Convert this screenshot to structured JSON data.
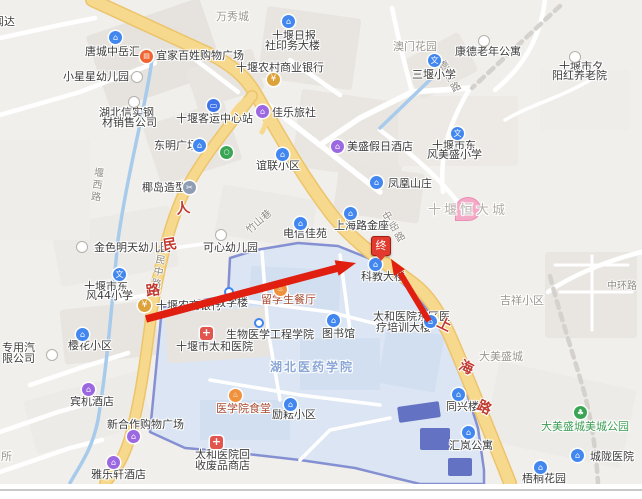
{
  "route": {
    "end_marker": "终"
  },
  "colors": {
    "main_road": "#f7d98e",
    "road_casing": "#ecc46b",
    "campus_fill": "#dbe5f3",
    "campus_border": "#8590d2",
    "water": "#a8cbec",
    "arrow_red": "#e01f10",
    "road_label_red": "#c13a30",
    "poi_blue": "#4187ef",
    "hospital_red": "#e2554e"
  },
  "road_names": {
    "renmin_chars": [
      "人",
      "民",
      "路"
    ],
    "shanghai_chars": [
      "上",
      "海",
      "路"
    ],
    "renmin_middle": "人民中路",
    "zhongyue": "中岳路",
    "zhushan_alley": "竹山巷",
    "yanxi": "堰西路",
    "deyang": "德阳路",
    "zhonghuan": "中环路"
  },
  "pois": {
    "wenda_partial": {
      "label": "闻达"
    },
    "wanxiucheng": {
      "label": "万秀城"
    },
    "tangcheng_zhongyuehui": {
      "label": "唐城中岳汇"
    },
    "yijia_baixing": {
      "label": "宜家百姓购物广场"
    },
    "xiaoxingxing_kindergarten": {
      "label": "小星星幼儿园"
    },
    "hubei_xinshi": {
      "line1": "湖北信实钢",
      "line2": "材销售公司"
    },
    "shiyan_ribao": {
      "line1": "十堰日报",
      "line2": "社印务大楼"
    },
    "aomen_garden": {
      "label": "澳门花园"
    },
    "kangde_apartment": {
      "label": "康德老年公寓"
    },
    "xiyanghong_home": {
      "line1": "十堰市夕",
      "line2": "阳红养老院"
    },
    "rural_commercial_bank": {
      "label": "十堰农村商业银行"
    },
    "sanyan_school": {
      "label": "三堰小学"
    },
    "keyun_center": {
      "label": "十堰客运中心站"
    },
    "jiale_hostel": {
      "label": "佳乐旅社"
    },
    "dongming_plaza": {
      "label": "东明广场"
    },
    "yilian_estate": {
      "label": "谊联小区"
    },
    "meisheng_hotel": {
      "label": "美盛假日酒店"
    },
    "meisheng_school": {
      "line1": "十堰市东",
      "line2": "风美盛小学"
    },
    "fenghuang_villa": {
      "label": "凤凰山庄"
    },
    "yedao_salon": {
      "label": "椰岛造型"
    },
    "jinse_kindergarten": {
      "label": "金色明天幼儿园"
    },
    "kexin_kindergarten": {
      "label": "可心幼儿园"
    },
    "dongfeng44_school": {
      "line1": "十堰市东",
      "line2": "风44小学"
    },
    "shanghailu_jinzuo": {
      "label": "上海路金座"
    },
    "dianxin_jiayuan": {
      "label": "电信佳苑"
    },
    "nongshang_bank": {
      "label": "十堰农商银行"
    },
    "jiaoxuelou": {
      "label": "教学楼"
    },
    "liuxuesheng_canteen": {
      "label": "留学生餐厅"
    },
    "kejiao_building": {
      "label": "科教大楼"
    },
    "taihe_hospital": {
      "label": "十堰市太和医院"
    },
    "shengwu_college": {
      "label": "生物医学工程学院"
    },
    "hubei_yiyao_university": {
      "label": "湖北医药学院"
    },
    "yixueyuan_canteen": {
      "label": "医学院食堂"
    },
    "liyun_estate": {
      "label": "励耘小区"
    },
    "tushuguan": {
      "label": "图书馆"
    },
    "taihe_dongqu": {
      "line1": "太和医院东区医",
      "line2": "疗培训大楼"
    },
    "tongxinglou": {
      "label": "同兴楼"
    },
    "huilan_apartment": {
      "label": "汇岚公寓"
    },
    "meicheng_park": {
      "label": "大美盛城美城公园"
    },
    "chenglong_hospital": {
      "label": "城陇医院"
    },
    "wutong_garden": {
      "label": "梧桐花园"
    },
    "jixiang_estate": {
      "label": "吉祥小区"
    },
    "dameisheng_city": {
      "label": "大美盛城"
    },
    "hengda_city": {
      "label": "十堰恒大城"
    },
    "binji_hotel": {
      "label": "宾机酒店"
    },
    "yinghua_estate": {
      "label": "樱花小区"
    },
    "company_partial": {
      "line1": "专用汽",
      "line2": "限公司"
    },
    "xinhezuo_mall": {
      "label": "新合作购物广场"
    },
    "yalexuan_hotel": {
      "label": "雅乐轩酒店"
    },
    "taihe_recycle": {
      "line1": "太和医院回",
      "line2": "收废品商店"
    },
    "suo_partial": {
      "label": "所"
    }
  }
}
